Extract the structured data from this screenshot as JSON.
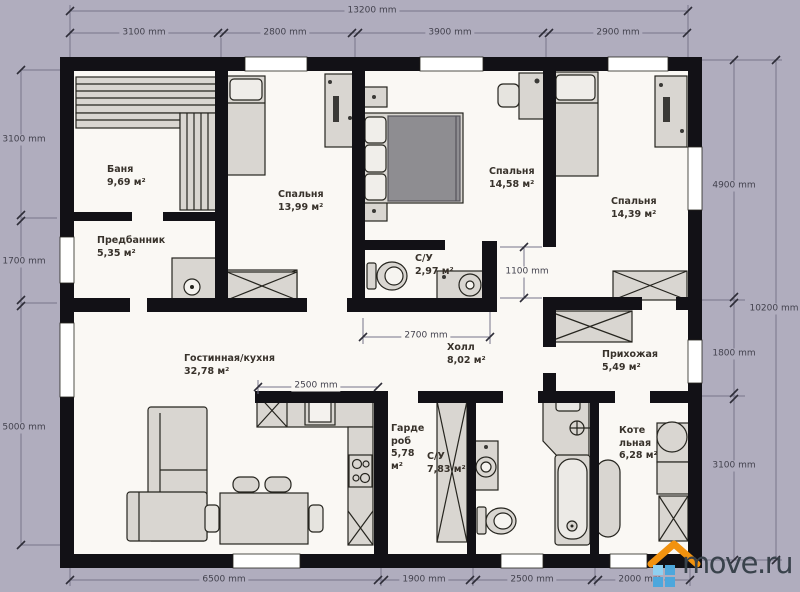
{
  "plan": {
    "unit": "mm",
    "rooms": [
      {
        "name": "Баня",
        "area": "9,69 м²"
      },
      {
        "name": "Предбанник",
        "area": "5,35 м²"
      },
      {
        "name": "Спальня",
        "area": "13,99 м²"
      },
      {
        "name": "Спальня",
        "area": "14,58 м²"
      },
      {
        "name": "Спальня",
        "area": "14,39 м²"
      },
      {
        "name": "С/У",
        "area": "2,97 м²"
      },
      {
        "name": "Холл",
        "area": "8,02 м²"
      },
      {
        "name": "Прихожая",
        "area": "5,49 м²"
      },
      {
        "name": "Гостинная/кухня",
        "area": "32,78 м²"
      },
      {
        "name": "Гарде роб",
        "area": "5,78 м²"
      },
      {
        "name": "С/У",
        "area": "7,83 м²"
      },
      {
        "name": "Коте льная",
        "area": "6,28 м²"
      }
    ],
    "dimensions": {
      "top_total": "13200 mm",
      "top_segments": [
        "3100 mm",
        "2800 mm",
        "3900 mm",
        "2900 mm"
      ],
      "left_segments": [
        "3100 mm",
        "1700 mm",
        "5000 mm"
      ],
      "right_segments": [
        "4900 mm",
        "1800 mm",
        "3100 mm"
      ],
      "right_total": "10200 mm",
      "bottom_segments": [
        "6500 mm",
        "1900 mm",
        "2500 mm",
        "2000 mm"
      ],
      "inner": {
        "hall_width": "2700 mm",
        "kitchen_width": "2500 mm",
        "corridor_width": "1100 mm"
      }
    }
  },
  "watermark": {
    "text": "move.ru"
  },
  "colors": {
    "background": "#b0adbe",
    "floor": "#faf8f4",
    "wall": "#121116",
    "furniture": "#d9d6d1",
    "mattress": "#8e8d91",
    "roof_accent": "#f2920f",
    "squares_accent": "#4da7dc",
    "logo_text": "#39424b"
  }
}
